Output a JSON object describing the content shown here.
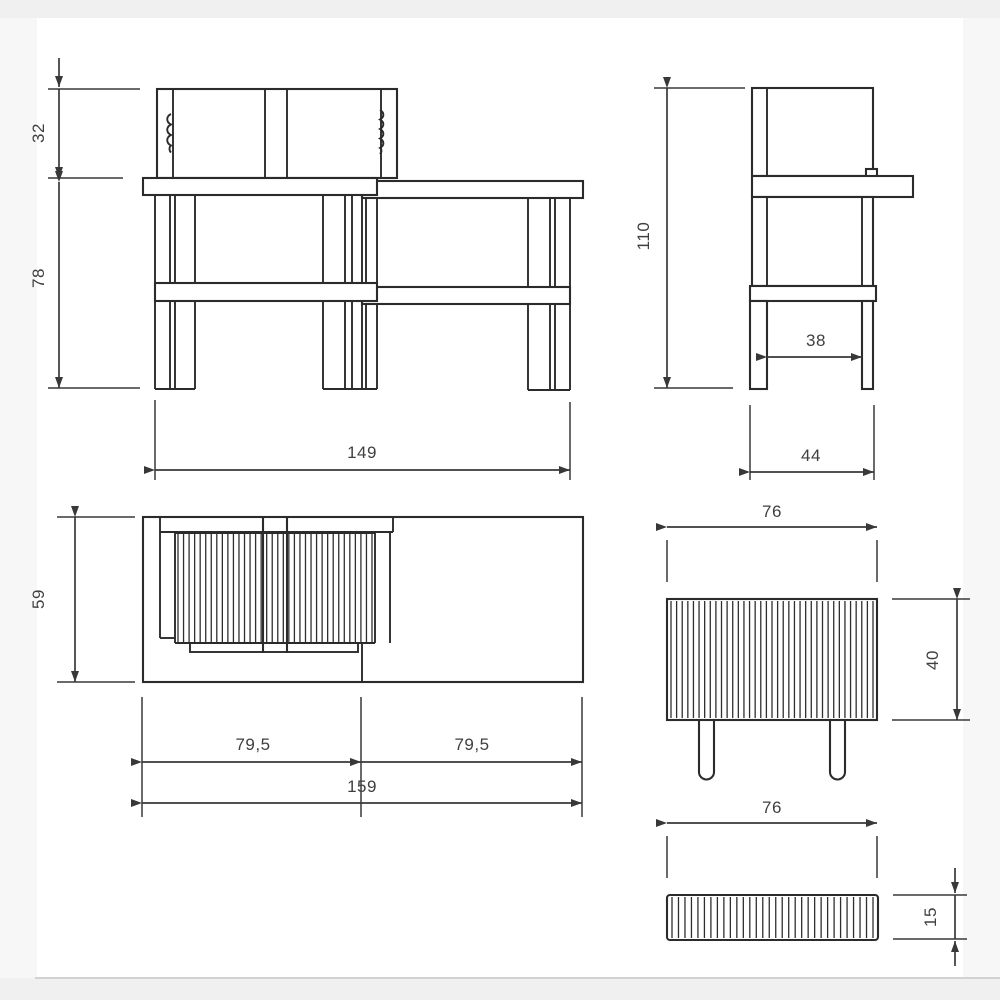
{
  "page": {
    "band_color": "#f0f0f1",
    "line_color": "#2b2b2b",
    "dimension_text_color": "#3f3f3f"
  },
  "views": {
    "front": {
      "dims": {
        "backrest_height": "32",
        "frame_height": "78",
        "frame_width": "149"
      }
    },
    "side": {
      "dims": {
        "overall_height": "110",
        "leg_clearance": "38",
        "frame_depth": "44"
      }
    },
    "plan": {
      "dims": {
        "seat_depth": "59",
        "left_half": "79,5",
        "right_half": "79,5",
        "overall_length": "159"
      }
    },
    "backrest_panel": {
      "dims": {
        "width": "76",
        "height": "40"
      }
    },
    "slat_board": {
      "dims": {
        "width": "76",
        "thickness": "15"
      }
    }
  }
}
